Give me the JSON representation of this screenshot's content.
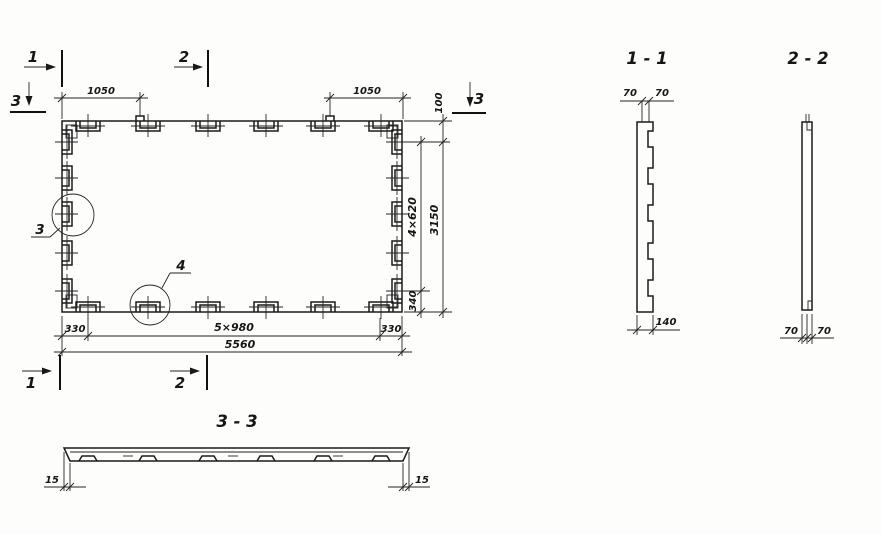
{
  "plan": {
    "markers": {
      "one_top": "1",
      "two_top": "2",
      "three_left": "3",
      "three_right": "3",
      "one_bottom": "1",
      "two_bottom": "2"
    },
    "details": {
      "left": "3",
      "bottom": "4"
    },
    "dims": {
      "top_left": "1050",
      "top_right": "1050",
      "right_top": "100",
      "right_chain": "4×620",
      "right_total": "3150",
      "right_bottom": "340",
      "bottom_left": "330",
      "bottom_chain": "5×980",
      "bottom_right": "330",
      "bottom_total": "5560"
    }
  },
  "sections": {
    "s11": {
      "title": "1 - 1",
      "left": "70",
      "right": "70",
      "bottom": "140"
    },
    "s22": {
      "title": "2 - 2",
      "left": "70",
      "right": "70"
    },
    "s33": {
      "title": "3 - 3",
      "left": "15",
      "right": "15"
    }
  },
  "colors": {
    "ink": "#1b1b1b",
    "paper": "#fdfdfc"
  }
}
